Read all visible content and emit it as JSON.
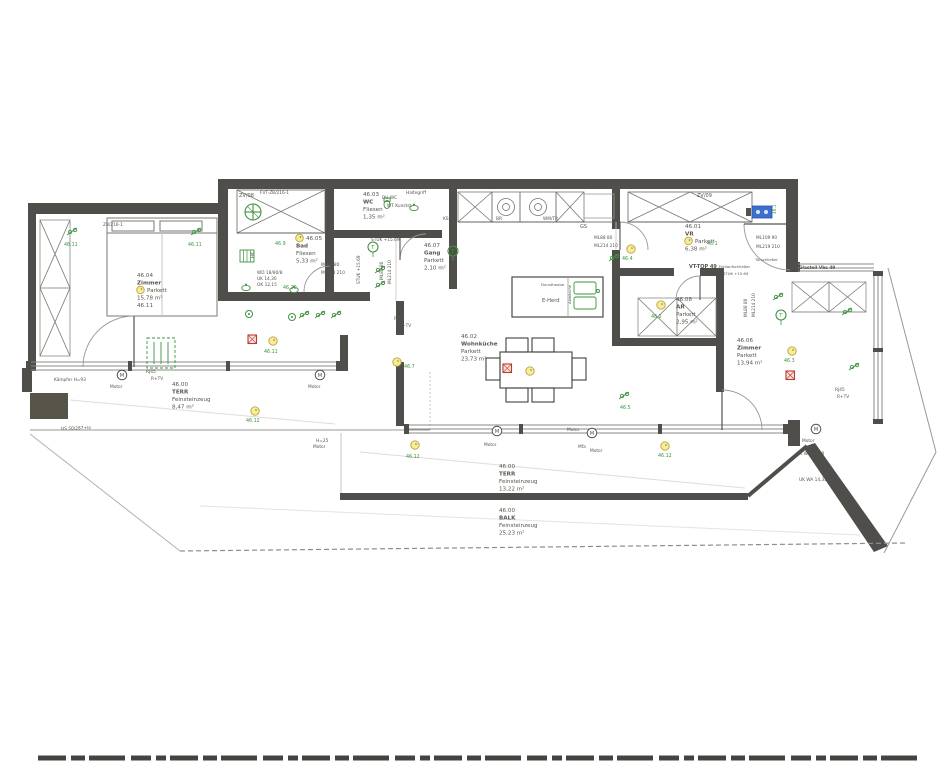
{
  "meta": {
    "unit_tag": "VT-TOP 49",
    "drawing_type": "floor-plan-scan"
  },
  "colors": {
    "wall": "#4f4e4a",
    "dark_fill": "#57544a",
    "line": "#8a8a86",
    "line_light": "#c6c5c0",
    "faint": "#dddcd7",
    "text": "#55544f",
    "green": "#3f9440",
    "yellow_fill": "#f6ec9b",
    "yellow_stroke": "#b9a53b",
    "red": "#c0392b",
    "blue": "#3b6fd0",
    "furn": "#77756f"
  },
  "rooms": [
    {
      "id": "46.04",
      "name": "Zimmer",
      "floor": "Parkett",
      "area": "15,78 m²",
      "extra": "46.11",
      "x": 137,
      "y": 277,
      "dot": 2
    },
    {
      "id": "46.05",
      "name": "Bad",
      "floor": "Fliesen",
      "area": "5,33 m²",
      "x": 296,
      "y": 240,
      "dot": 0
    },
    {
      "id": "46.03",
      "name": "WC",
      "floor": "Fliesen",
      "area": "1,35 m²",
      "x": 363,
      "y": 196
    },
    {
      "id": "46.07",
      "name": "Gang",
      "floor": "Parkett",
      "area": "2,10 m²",
      "x": 424,
      "y": 247
    },
    {
      "id": "46.02",
      "name": "Wohnküche",
      "floor": "Parkett",
      "area": "23,73 m²",
      "x": 461,
      "y": 338
    },
    {
      "id": "46.01",
      "name": "VR",
      "floor": "Parkett",
      "area": "6,38 m²",
      "x": 685,
      "y": 228,
      "dot": 2
    },
    {
      "id": "46.08",
      "name": "AR",
      "floor": "Parkett",
      "area": "2,95 m²",
      "x": 676,
      "y": 301
    },
    {
      "id": "46.06",
      "name": "Zimmer",
      "floor": "Parkett",
      "area": "13,94 m²",
      "x": 737,
      "y": 342
    },
    {
      "id": "46.00",
      "name": "TERR",
      "floor": "Feinsteinzeug",
      "area": "8,47 m²",
      "x": 172,
      "y": 386
    },
    {
      "id": "46.00",
      "name": "TERR",
      "floor": "Feinsteinzeug",
      "area": "13,22 m²",
      "x": 499,
      "y": 468
    },
    {
      "id": "46.00",
      "name": "BALK",
      "floor": "Feinsteinzeug",
      "area": "25,23 m²",
      "x": 499,
      "y": 512
    }
  ],
  "markers": [
    {
      "x": 273,
      "y": 341,
      "label": "46.11",
      "lx": 264,
      "ly": 353
    },
    {
      "x": 255,
      "y": 411,
      "label": "46.12",
      "lx": 246,
      "ly": 422
    },
    {
      "x": 397,
      "y": 362,
      "label": "46.7",
      "lx": 404,
      "ly": 368
    },
    {
      "x": 631,
      "y": 249,
      "label": "46.4",
      "lx": 622,
      "ly": 260
    },
    {
      "x": 661,
      "y": 305,
      "label": "46.2",
      "lx": 651,
      "ly": 318
    },
    {
      "x": 530,
      "y": 371,
      "label": ""
    },
    {
      "x": 792,
      "y": 351,
      "label": "46.3",
      "lx": 784,
      "ly": 362
    },
    {
      "x": 415,
      "y": 445,
      "label": "46.12",
      "lx": 406,
      "ly": 458
    },
    {
      "x": 665,
      "y": 446,
      "label": "46.12",
      "lx": 658,
      "ly": 457
    }
  ],
  "green_texts": [
    {
      "t": "46.11",
      "x": 64,
      "y": 246
    },
    {
      "t": "46.11",
      "x": 188,
      "y": 246
    },
    {
      "t": "46.9",
      "x": 275,
      "y": 245
    },
    {
      "t": "46.10",
      "x": 283,
      "y": 289
    },
    {
      "t": "46.5",
      "x": 620,
      "y": 409
    },
    {
      "t": "46.1",
      "x": 707,
      "y": 245
    }
  ],
  "smoke_detectors": [
    {
      "x": 248,
      "y": 335
    },
    {
      "x": 503,
      "y": 364
    },
    {
      "x": 786,
      "y": 371
    }
  ],
  "motors": [
    {
      "x": 122,
      "y": 375
    },
    {
      "x": 320,
      "y": 375
    },
    {
      "x": 497,
      "y": 431
    },
    {
      "x": 592,
      "y": 433
    },
    {
      "x": 816,
      "y": 429
    }
  ],
  "thermostats": [
    {
      "x": 373,
      "y": 247
    },
    {
      "x": 453,
      "y": 251
    },
    {
      "x": 781,
      "y": 315
    }
  ],
  "lamps": [
    {
      "x": 249,
      "y": 314
    },
    {
      "x": 292,
      "y": 317
    }
  ],
  "clusters": [
    {
      "x": 70,
      "y": 232
    },
    {
      "x": 194,
      "y": 232
    },
    {
      "x": 612,
      "y": 258
    },
    {
      "x": 622,
      "y": 396
    },
    {
      "x": 776,
      "y": 297
    },
    {
      "x": 852,
      "y": 367
    },
    {
      "x": 246,
      "y": 288,
      "v": "basin"
    },
    {
      "x": 294,
      "y": 290,
      "v": "basin"
    },
    {
      "x": 387,
      "y": 203,
      "v": "wc"
    },
    {
      "x": 414,
      "y": 208,
      "v": "basin"
    },
    {
      "x": 302,
      "y": 315
    },
    {
      "x": 318,
      "y": 315
    },
    {
      "x": 334,
      "y": 315
    },
    {
      "x": 378,
      "y": 270
    },
    {
      "x": 378,
      "y": 285
    },
    {
      "x": 240,
      "y": 250,
      "v": "rad"
    },
    {
      "x": 845,
      "y": 312
    }
  ],
  "annotations": [
    {
      "t": "ZV/08",
      "x": 239,
      "y": 197,
      "s": 5
    },
    {
      "t": "FVT-ZB/216-1",
      "x": 260,
      "y": 194,
      "s": 4.3
    },
    {
      "t": "ZB/216-1",
      "x": 103,
      "y": 226,
      "s": 4.3
    },
    {
      "t": "ZV/09",
      "x": 697,
      "y": 197,
      "s": 5
    },
    {
      "t": "DU-WC",
      "x": 382,
      "y": 199,
      "s": 4.3
    },
    {
      "t": "Haltegriff",
      "x": 406,
      "y": 194,
      "s": 4.3
    },
    {
      "t": "WT Kunstst.",
      "x": 387,
      "y": 207,
      "s": 4.3
    },
    {
      "t": "STUK +15.69",
      "x": 371,
      "y": 241,
      "s": 4.3
    },
    {
      "t": "STUK +15.69",
      "x": 360,
      "y": 284,
      "s": 4.3,
      "r": -90
    },
    {
      "t": "ML88  80",
      "x": 383,
      "y": 280,
      "s": 4.3,
      "r": -90
    },
    {
      "t": "ML214  210",
      "x": 391,
      "y": 284,
      "s": 4.3,
      "r": -90
    },
    {
      "t": "ML88  80",
      "x": 321,
      "y": 266,
      "s": 4.3
    },
    {
      "t": "ML214  210",
      "x": 321,
      "y": 274,
      "s": 4.3
    },
    {
      "t": "WD 18/80/8",
      "x": 257,
      "y": 274,
      "s": 4.3
    },
    {
      "t": "UK 14,30",
      "x": 257,
      "y": 280,
      "s": 4.3
    },
    {
      "t": "OK 12,15",
      "x": 257,
      "y": 286,
      "s": 4.3
    },
    {
      "t": "HK",
      "x": 254,
      "y": 258,
      "s": 4.3,
      "r": -90
    },
    {
      "t": "KS",
      "x": 443,
      "y": 220,
      "s": 4.3
    },
    {
      "t": "BR",
      "x": 496,
      "y": 220,
      "s": 4.3
    },
    {
      "t": "WM/TR",
      "x": 543,
      "y": 220,
      "s": 4.3
    },
    {
      "t": "GS",
      "x": 580,
      "y": 228,
      "s": 5
    },
    {
      "t": "ML88  80",
      "x": 594,
      "y": 239,
      "s": 4.3
    },
    {
      "t": "ML214  210",
      "x": 594,
      "y": 247,
      "s": 4.3
    },
    {
      "t": "Dunsthaube",
      "x": 541,
      "y": 286,
      "s": 3.8
    },
    {
      "t": "E-Herd",
      "x": 542,
      "y": 302,
      "s": 5.2
    },
    {
      "t": "Abwäsche",
      "x": 571,
      "y": 304,
      "s": 3.8,
      "r": -90
    },
    {
      "t": "ML109  90",
      "x": 756,
      "y": 239,
      "s": 4.3
    },
    {
      "t": "ML219  210",
      "x": 756,
      "y": 248,
      "s": 4.3
    },
    {
      "t": "Türschließer",
      "x": 755,
      "y": 261,
      "s": 3.8
    },
    {
      "t": "Freilaufschließer",
      "x": 719,
      "y": 268,
      "s": 3.8
    },
    {
      "t": "STUK +15.69",
      "x": 723,
      "y": 275,
      "s": 3.8
    },
    {
      "t": "VT-TOP 49",
      "x": 689,
      "y": 268,
      "s": 5,
      "b": 1
    },
    {
      "t": "Glasteil Vbs 49",
      "x": 799,
      "y": 269,
      "s": 4.3,
      "b": 1
    },
    {
      "t": "46.1",
      "x": 776,
      "y": 214,
      "s": 4.3,
      "r": -90,
      "c": "g"
    },
    {
      "t": "ML88  80",
      "x": 747,
      "y": 317,
      "s": 4.3,
      "r": -90
    },
    {
      "t": "ML214  210",
      "x": 755,
      "y": 317,
      "s": 4.3,
      "r": -90
    },
    {
      "t": "RJ45",
      "x": 394,
      "y": 320,
      "s": 4.3
    },
    {
      "t": "R+TV",
      "x": 399,
      "y": 327,
      "s": 4.3
    },
    {
      "t": "RJ45",
      "x": 146,
      "y": 373,
      "s": 4.3
    },
    {
      "t": "R+TV",
      "x": 151,
      "y": 380,
      "s": 4.3
    },
    {
      "t": "RJ45",
      "x": 835,
      "y": 391,
      "s": 4.3
    },
    {
      "t": "R+TV",
      "x": 837,
      "y": 398,
      "s": 4.3
    },
    {
      "t": "Kämpfer H=93",
      "x": 54,
      "y": 381,
      "s": 4.3
    },
    {
      "t": "DS 50/287+la",
      "x": 61,
      "y": 430,
      "s": 4.3,
      "r": -2
    },
    {
      "t": "Motor",
      "x": 110,
      "y": 388,
      "s": 4.3
    },
    {
      "t": "Motor",
      "x": 308,
      "y": 388,
      "s": 4.3
    },
    {
      "t": "H=25",
      "x": 316,
      "y": 442,
      "s": 4.3
    },
    {
      "t": "Motor",
      "x": 313,
      "y": 448,
      "s": 4.3
    },
    {
      "t": "Motor",
      "x": 484,
      "y": 446,
      "s": 4.3
    },
    {
      "t": "Motor",
      "x": 567,
      "y": 431,
      "s": 4.3
    },
    {
      "t": "Mfa",
      "x": 578,
      "y": 448,
      "s": 4.3
    },
    {
      "t": "Motor",
      "x": 590,
      "y": 452,
      "s": 4.3
    },
    {
      "t": "Motor",
      "x": 802,
      "y": 442,
      "s": 4.3
    },
    {
      "t": "OK WA 17,08",
      "x": 796,
      "y": 455,
      "s": 4.3
    },
    {
      "t": "UK WA 14,35",
      "x": 799,
      "y": 481,
      "s": 4.3
    },
    {
      "t": "Mfa",
      "x": 449,
      "y": 287,
      "s": 4.3
    }
  ]
}
